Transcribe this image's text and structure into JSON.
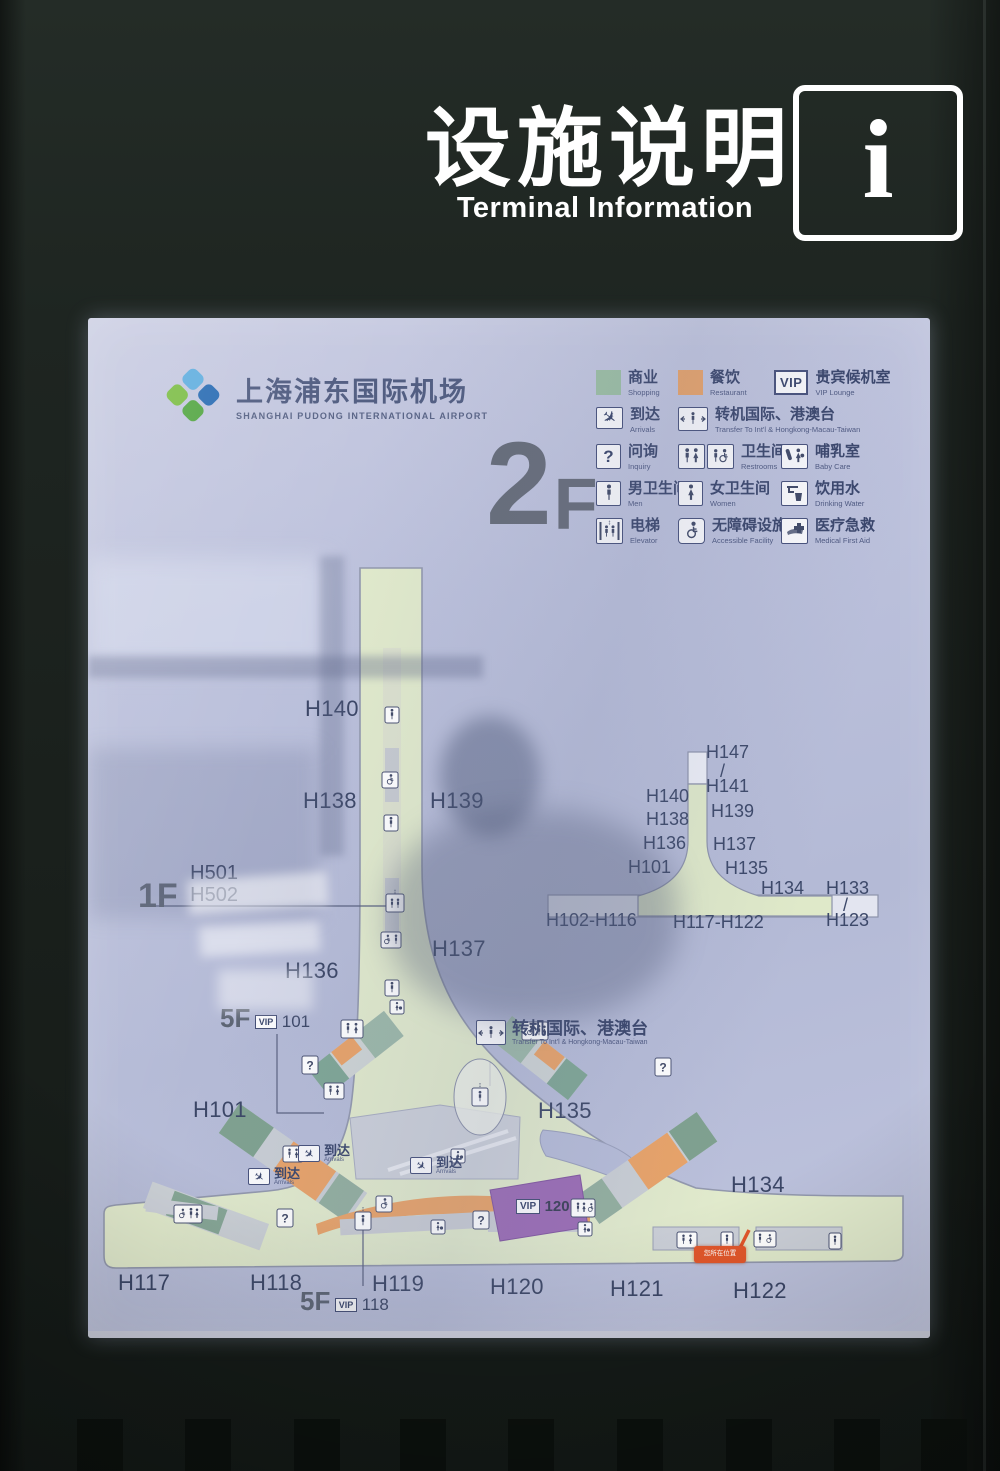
{
  "header": {
    "title_zh": "设施说明",
    "title_en": "Terminal Information",
    "info_glyph": "i"
  },
  "panel": {
    "logo": {
      "name_zh": "上海浦东国际机场",
      "name_en": "SHANGHAI PUDONG INTERNATIONAL AIRPORT"
    },
    "floor_number": "2",
    "floor_letter": "F"
  },
  "legend": {
    "shopping": {
      "zh": "商业",
      "en": "Shopping"
    },
    "restaurant": {
      "zh": "餐饮",
      "en": "Restaurant"
    },
    "vip": {
      "badge": "VIP",
      "zh": "贵宾候机室",
      "en": "VIP Lounge"
    },
    "arrivals": {
      "zh": "到达",
      "en": "Arrivals"
    },
    "transfer": {
      "zh": "转机国际、港澳台",
      "en": "Transfer To Int'l & Hongkong-Macau-Taiwan"
    },
    "inquiry": {
      "zh": "问询",
      "en": "Inquiry"
    },
    "restrooms": {
      "zh": "卫生间",
      "en": "Restrooms"
    },
    "baby_care": {
      "zh": "哺乳室",
      "en": "Baby Care"
    },
    "men": {
      "zh": "男卫生间",
      "en": "Men"
    },
    "women": {
      "zh": "女卫生间",
      "en": "Women"
    },
    "drinking_water": {
      "zh": "饮用水",
      "en": "Drinking Water"
    },
    "elevator": {
      "zh": "电梯",
      "en": "Elevator"
    },
    "accessible": {
      "zh": "无障碍设施",
      "en": "Accessible Facility"
    },
    "medical": {
      "zh": "医疗急救",
      "en": "Medical First Aid"
    }
  },
  "map": {
    "gates": {
      "h140": "H140",
      "h138": "H138",
      "h139": "H139",
      "h137": "H137",
      "h136": "H136",
      "h101": "H101",
      "h135": "H135",
      "h134": "H134",
      "h117": "H117",
      "h118": "H118",
      "h119": "H119",
      "h120": "H120",
      "h121": "H121",
      "h122": "H122"
    },
    "level_1f": {
      "floor": "1F",
      "line1": "H501",
      "line2": "H502"
    },
    "level_5f_101": {
      "floor": "5F",
      "badge": "VIP",
      "number": "101"
    },
    "level_5f_118": {
      "floor": "5F",
      "badge": "VIP",
      "number": "118"
    },
    "transfer_counter": {
      "zh": "转机国际、港澳台",
      "en": "Transfer To Int'l & Hongkong-Macau-Taiwan"
    },
    "vip_area": {
      "badge": "VIP",
      "number": "120"
    },
    "you_are_here": "您所在位置",
    "arrivals_zh": "到达",
    "arrivals_en": "Arrivals",
    "question_glyph": "?"
  },
  "inset": {
    "h147": "H147",
    "h141": "H141",
    "h140": "H140",
    "h139": "H139",
    "h138": "H138",
    "h136": "H136",
    "h137": "H137",
    "h101": "H101",
    "h135": "H135",
    "h134": "H134",
    "h133": "H133",
    "h123": "H123",
    "slash": "/",
    "range_left": "H102-H116",
    "range_center": "H117-H122"
  },
  "colors": {
    "shopping_green": "#9cbfa3",
    "restaurant_orange": "#e9a368",
    "vip_purple": "#9b6cb5",
    "map_green": "#e1eacc",
    "panel_lavender": "#bcc1dc",
    "marker_red": "#e2572b",
    "label_blue": "#3b4666",
    "kiosk_dark": "#1a201c"
  }
}
